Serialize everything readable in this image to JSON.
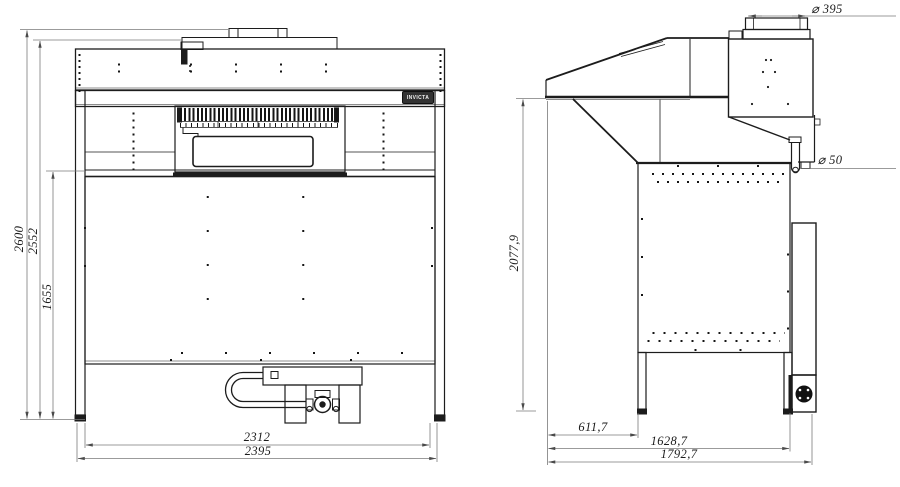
{
  "front_view": {
    "logo_text": "INVICTA",
    "dims": {
      "overall_height": "2600",
      "body_height": "2552",
      "worktop_height": "1655",
      "inner_width": "2312",
      "overall_width": "2395"
    }
  },
  "side_view": {
    "dims": {
      "hood_height": "2077,9",
      "front_offset": "611,7",
      "frame_depth": "1628,7",
      "overall_depth": "1792,7",
      "duct_diameter": "⌀ 395",
      "drain_diameter": "⌀ 50"
    }
  },
  "colors": {
    "line": "#1c1c1c",
    "dim_line": "#7a7a7a",
    "background": "#ffffff"
  }
}
